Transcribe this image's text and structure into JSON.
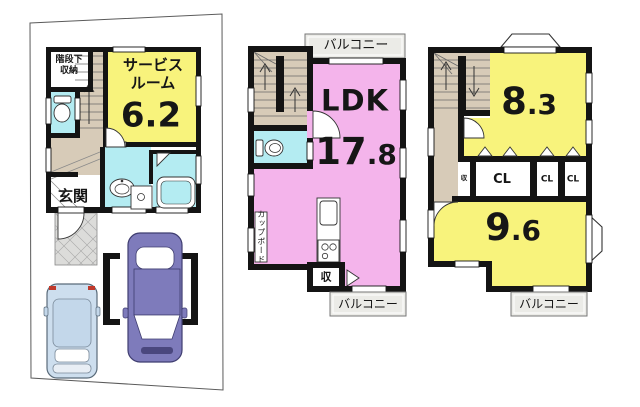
{
  "floor1": {
    "under_stairs_storage_line1": "階段下",
    "under_stairs_storage_line2": "収納",
    "service_room_line1": "サービス",
    "service_room_line2": "ルーム",
    "service_room_area": "6.2",
    "entrance_label": "玄関"
  },
  "floor2": {
    "balcony_top_label": "バルコニー",
    "ldk_label": "LDK",
    "ldk_area_main": "17",
    "ldk_area_frac": ".8",
    "cupboard_label": "カップボード",
    "storage_label": "収",
    "balcony_bottom_label": "バルコニー"
  },
  "floor3": {
    "room_a_area_main": "8",
    "room_a_area_frac": ".3",
    "small_storage_label": "収",
    "closet1_label": "CL",
    "closet2_label": "CL",
    "closet3_label": "CL",
    "room_b_area_main": "9",
    "room_b_area_frac": ".6",
    "balcony_label": "バルコニー"
  },
  "colors": {
    "wall": "#141414",
    "room_yellow": "#f8f37c",
    "room_pink": "#f4b4eb",
    "room_cyan": "#b4ecf2",
    "hall_beige": "#d7cbb8",
    "balcony_gray": "#ebebe7",
    "porch_gray": "#dcdcda",
    "car_blue": "#cddeee",
    "car_purple": "#7e7bbb"
  }
}
